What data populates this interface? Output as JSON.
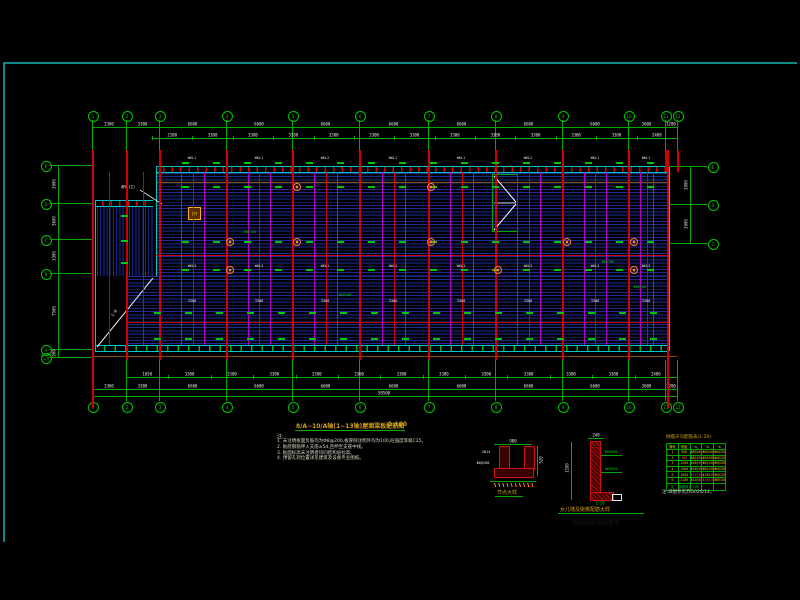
{
  "palette": {
    "bg": "#000000",
    "frame_cyan": "#0c8a8a",
    "grid_green": "#00a800",
    "bubble_green": "#00c800",
    "rib_blue": "#1c2b96",
    "grid_red": "#d40000",
    "magenta": "#b400c8",
    "band_cyan": "#00c8c8",
    "dim_white": "#e8e8e8",
    "anno_yellow": "#d0a018",
    "table_green": "#00a000",
    "orange": "#ff7f27"
  },
  "grid": {
    "top": {
      "y": 115,
      "items": [
        {
          "x": 92,
          "label": "1"
        },
        {
          "x": 126,
          "label": "2"
        },
        {
          "x": 159,
          "label": "3"
        },
        {
          "x": 226,
          "label": "4"
        },
        {
          "x": 292,
          "label": "5"
        },
        {
          "x": 359,
          "label": "6"
        },
        {
          "x": 428,
          "label": "7"
        },
        {
          "x": 495,
          "label": "8"
        },
        {
          "x": 562,
          "label": "9"
        },
        {
          "x": 628,
          "label": "10"
        },
        {
          "x": 665,
          "label": "11"
        },
        {
          "x": 677,
          "label": "12"
        }
      ]
    },
    "bottom": {
      "y": 406,
      "items": [
        {
          "x": 92,
          "label": "1"
        },
        {
          "x": 126,
          "label": "2"
        },
        {
          "x": 159,
          "label": "3"
        },
        {
          "x": 226,
          "label": "4"
        },
        {
          "x": 292,
          "label": "5"
        },
        {
          "x": 359,
          "label": "6"
        },
        {
          "x": 428,
          "label": "7"
        },
        {
          "x": 495,
          "label": "8"
        },
        {
          "x": 562,
          "label": "9"
        },
        {
          "x": 628,
          "label": "10"
        },
        {
          "x": 665,
          "label": "11"
        },
        {
          "x": 677,
          "label": "12"
        }
      ]
    },
    "left": {
      "x": 45,
      "items": [
        {
          "y": 165,
          "label": "E"
        },
        {
          "y": 203,
          "label": "D"
        },
        {
          "y": 239,
          "label": "C"
        },
        {
          "y": 273,
          "label": "B"
        },
        {
          "y": 349,
          "label": "A"
        },
        {
          "y": 357,
          "label": "1/A"
        }
      ]
    },
    "right": {
      "x": 712,
      "items": [
        {
          "y": 166,
          "label": "E"
        },
        {
          "y": 204,
          "label": "D"
        },
        {
          "y": 243,
          "label": "C"
        }
      ]
    }
  },
  "dimensions": {
    "top_row1": {
      "y": 127,
      "values": [
        "3300",
        "3300",
        "6600",
        "6600",
        "6600",
        "6600",
        "6600",
        "6600",
        "6600",
        "3600",
        "1200"
      ]
    },
    "top_row2": {
      "y": 138,
      "x1": 152,
      "x2": 677,
      "values": [
        "2100",
        "3300",
        "3300",
        "3300",
        "3300",
        "3300",
        "3300",
        "3300",
        "3300",
        "3300",
        "3300",
        "3300",
        "2400"
      ]
    },
    "bottom_row1": {
      "y": 377,
      "x1": 126,
      "x2": 677,
      "values": [
        "1650",
        "3300",
        "3300",
        "3300",
        "3300",
        "3300",
        "3300",
        "3300",
        "3300",
        "3300",
        "3300",
        "3300",
        "2400"
      ]
    },
    "bottom_row2": {
      "y": 389,
      "values": [
        "3300",
        "3300",
        "6600",
        "6600",
        "6600",
        "6600",
        "6600",
        "6600",
        "6600",
        "3600",
        "1200"
      ]
    },
    "bottom_total": {
      "y": 396,
      "value": "58500"
    },
    "left_col": {
      "x": 58,
      "ys": [
        165,
        203,
        239,
        273,
        349,
        357
      ],
      "values": [
        "3900",
        "3600",
        "3300",
        "7500",
        "900"
      ]
    },
    "right_col": {
      "x": 690,
      "ys": [
        166,
        204,
        243
      ],
      "values": [
        "3900",
        "3900"
      ]
    }
  },
  "plan": {
    "beam_labels_top": {
      "y": 158,
      "items": [
        {
          "x": 192,
          "t": "WKL1"
        },
        {
          "x": 259,
          "t": "WKL1"
        },
        {
          "x": 325,
          "t": "WKL2"
        },
        {
          "x": 393,
          "t": "WKL1"
        },
        {
          "x": 461,
          "t": "WKL1"
        },
        {
          "x": 528,
          "t": "WKL2"
        },
        {
          "x": 595,
          "t": "WKL1"
        },
        {
          "x": 646,
          "t": "WKL1"
        }
      ]
    },
    "beam_labels_mid": {
      "y": 266,
      "items": [
        {
          "x": 192,
          "t": "WKL3"
        },
        {
          "x": 259,
          "t": "WKL3"
        },
        {
          "x": 325,
          "t": "WKL3"
        },
        {
          "x": 393,
          "t": "WKL3"
        },
        {
          "x": 461,
          "t": "WKL3"
        },
        {
          "x": 528,
          "t": "WKL3"
        },
        {
          "x": 595,
          "t": "WKL3"
        },
        {
          "x": 646,
          "t": "WKL3"
        }
      ]
    },
    "dims_mid": {
      "y": 301,
      "items": [
        {
          "x": 192,
          "t": "3300"
        },
        {
          "x": 259,
          "t": "3300"
        },
        {
          "x": 325,
          "t": "3300"
        },
        {
          "x": 393,
          "t": "3300"
        },
        {
          "x": 461,
          "t": "3300"
        },
        {
          "x": 528,
          "t": "3300"
        },
        {
          "x": 595,
          "t": "3300"
        },
        {
          "x": 646,
          "t": "3300"
        }
      ]
    },
    "green_notes": [
      {
        "x": 345,
        "y": 295,
        "t": "Φ8@200"
      },
      {
        "x": 608,
        "y": 262,
        "t": "Φ8@200"
      },
      {
        "x": 250,
        "y": 232,
        "t": "Φ8@150"
      },
      {
        "x": 640,
        "y": 287,
        "t": "Φ8@200"
      }
    ],
    "annex_label": "4M6(2)",
    "ramp_label": "1:8",
    "elevator_label": "DT"
  },
  "title_block": {
    "title": "8/A~10/A轴(1~13轴)屋面梁板配筋图",
    "scale": "1:100"
  },
  "notes": {
    "head": "注:",
    "lines": [
      "1. 未注明板面负筋均为Φ8@200,板厚除注明外均为100,砼强度等级C25。",
      "2. 板底钢筋伸入支座≥5d,且伸至支座中线。",
      "3. 板面标高未注明者均同结构层标高。",
      "4. 预留孔洞位置详见建筑及设备专业图纸。"
    ]
  },
  "detail_a": {
    "dim_top": "900",
    "dim_right": "520",
    "label1": "2Φ14",
    "label2": "Φ6@200",
    "caption": "节点大样"
  },
  "detail_b": {
    "dim_left": "1100",
    "dim_top": "240",
    "note1": "Φ8@200",
    "note2": "Φ6@250",
    "scale": "1:20",
    "caption": "女儿墙及挑檐配筋大样"
  },
  "rebar_table": {
    "title": "挑檐天沟配筋表(1:20)",
    "header": [
      "编号",
      "宽度",
      "①",
      "②",
      "③"
    ],
    "rows": [
      [
        "1",
        "600",
        "Φ8@200",
        "Φ8@200",
        "Φ6@250"
      ],
      [
        "2",
        "900",
        "Φ8@150",
        "Φ8@200",
        "Φ6@250"
      ],
      [
        "3",
        "1200",
        "Φ10@150",
        "Φ8@150",
        "Φ6@200"
      ],
      [
        "4",
        "1500",
        "Φ10@100",
        "Φ8@150",
        "Φ6@200"
      ],
      [
        "5",
        "1800",
        "Φ12@100",
        "Φ10@150",
        "Φ6@150"
      ],
      [
        "6",
        "2100",
        "Φ12@100",
        "Φ10@100",
        "Φ6@150"
      ]
    ],
    "last_row": [
      "注",
      "挑檐厚100",
      "C25",
      "",
      ""
    ],
    "red_cells": [
      [
        1,
        1
      ],
      [
        4,
        2
      ],
      [
        5,
        3
      ]
    ],
    "note": "注:详图参见苏G02S/14。"
  },
  "ghost_text": "网络图纸仅供参考"
}
